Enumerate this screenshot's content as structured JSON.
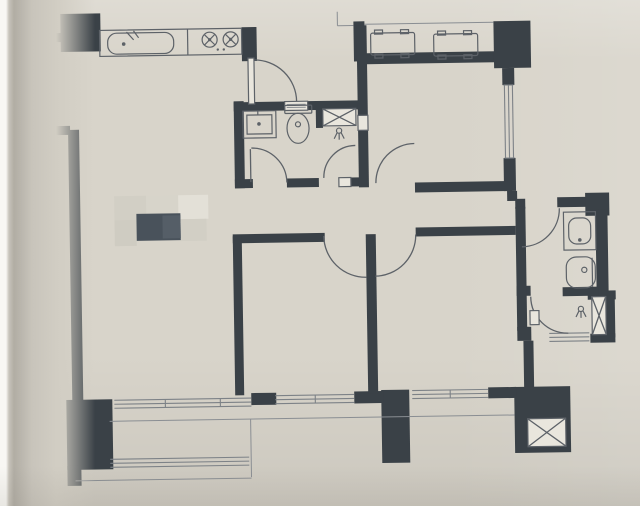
{
  "meta": {
    "content": "apartment floor plan printed on a magazine page, photographed at a slight tilt",
    "censor_patch": "pixelated redaction block over the living-room area (no readable text)"
  },
  "colors": {
    "paper": "#d8d4ca",
    "pageEdge": "#f8f7f3",
    "foldShadow": "#b1ada4",
    "wall": "#3a4147",
    "line": "#5d6268",
    "thin": "#8a8e93",
    "winline": "#7d8287",
    "fixture": "#e2dfd5",
    "blockWhite": "#e9e6dd",
    "censorDark": "#49525b",
    "censorDark2": "#555e67",
    "censorMid": "#d2cfc5",
    "censorLight": "#e3e0d7"
  },
  "fixtures": [
    "kitchen-counter",
    "kitchen-sink",
    "stove-burner x2",
    "ac-outdoor-unit x2",
    "bathroom-vanity x2",
    "toilet x2",
    "shower-head x2",
    "duct-x-shaft x3",
    "door-swing-arc x9",
    "window-band x5",
    "balcony-railing",
    "structural-column x4",
    "censor-pixelation-patch"
  ]
}
